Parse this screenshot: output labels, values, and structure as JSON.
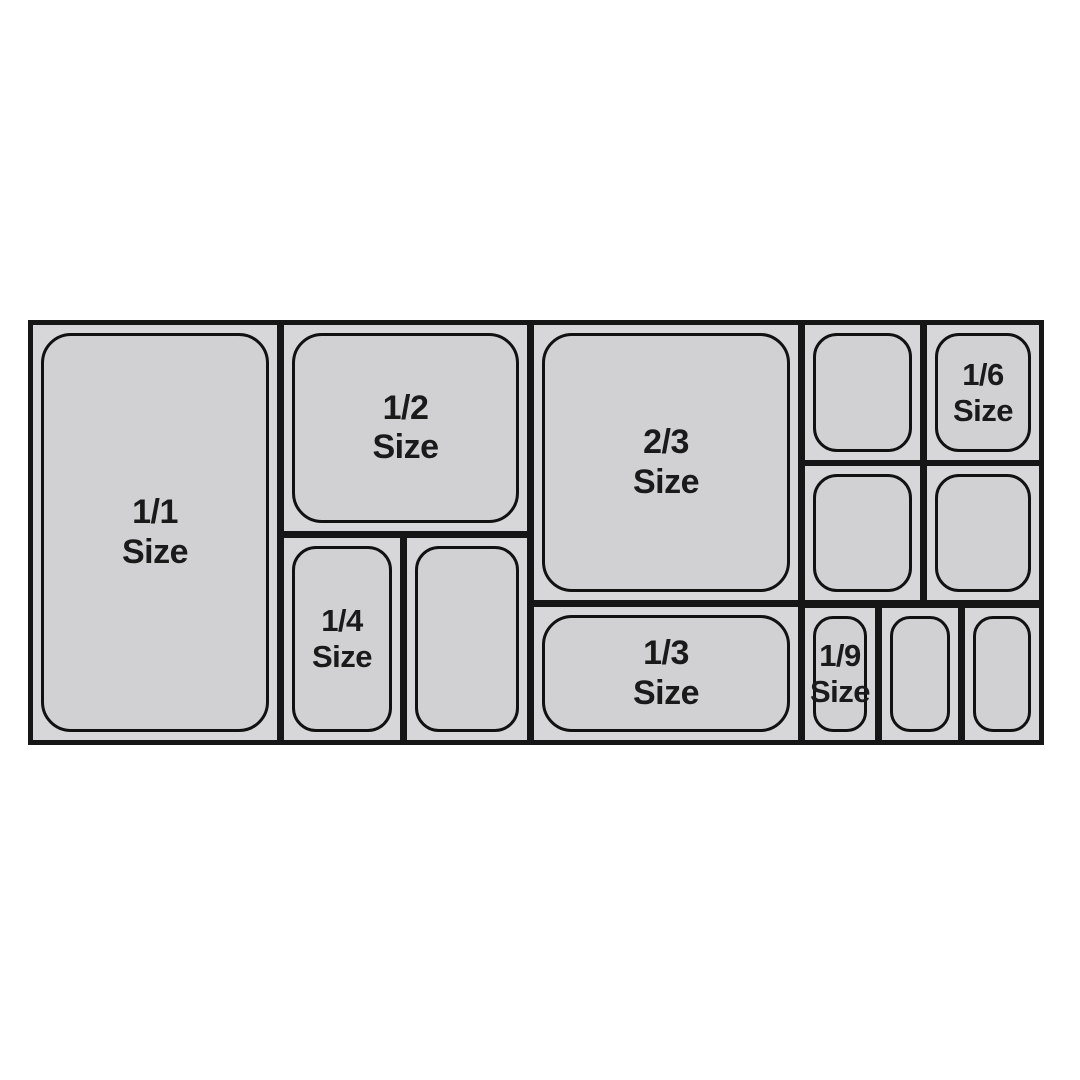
{
  "diagram": {
    "name": "gastronorm-pan-size-chart",
    "colors": {
      "background": "#ffffff",
      "line": "#161616",
      "pan_fill": "#d1d1d3",
      "cell_fill": "#d7d7d9",
      "label_text": "#1a1a1a"
    },
    "pans": {
      "full": {
        "fraction": "1/1",
        "word": "Size"
      },
      "half": {
        "fraction": "1/2",
        "word": "Size"
      },
      "two_thirds": {
        "fraction": "2/3",
        "word": "Size"
      },
      "third": {
        "fraction": "1/3",
        "word": "Size"
      },
      "quarter": {
        "fraction": "1/4",
        "word": "Size"
      },
      "sixth": {
        "fraction": "1/6",
        "word": "Size"
      },
      "ninth": {
        "fraction": "1/9",
        "word": "Size"
      }
    }
  }
}
